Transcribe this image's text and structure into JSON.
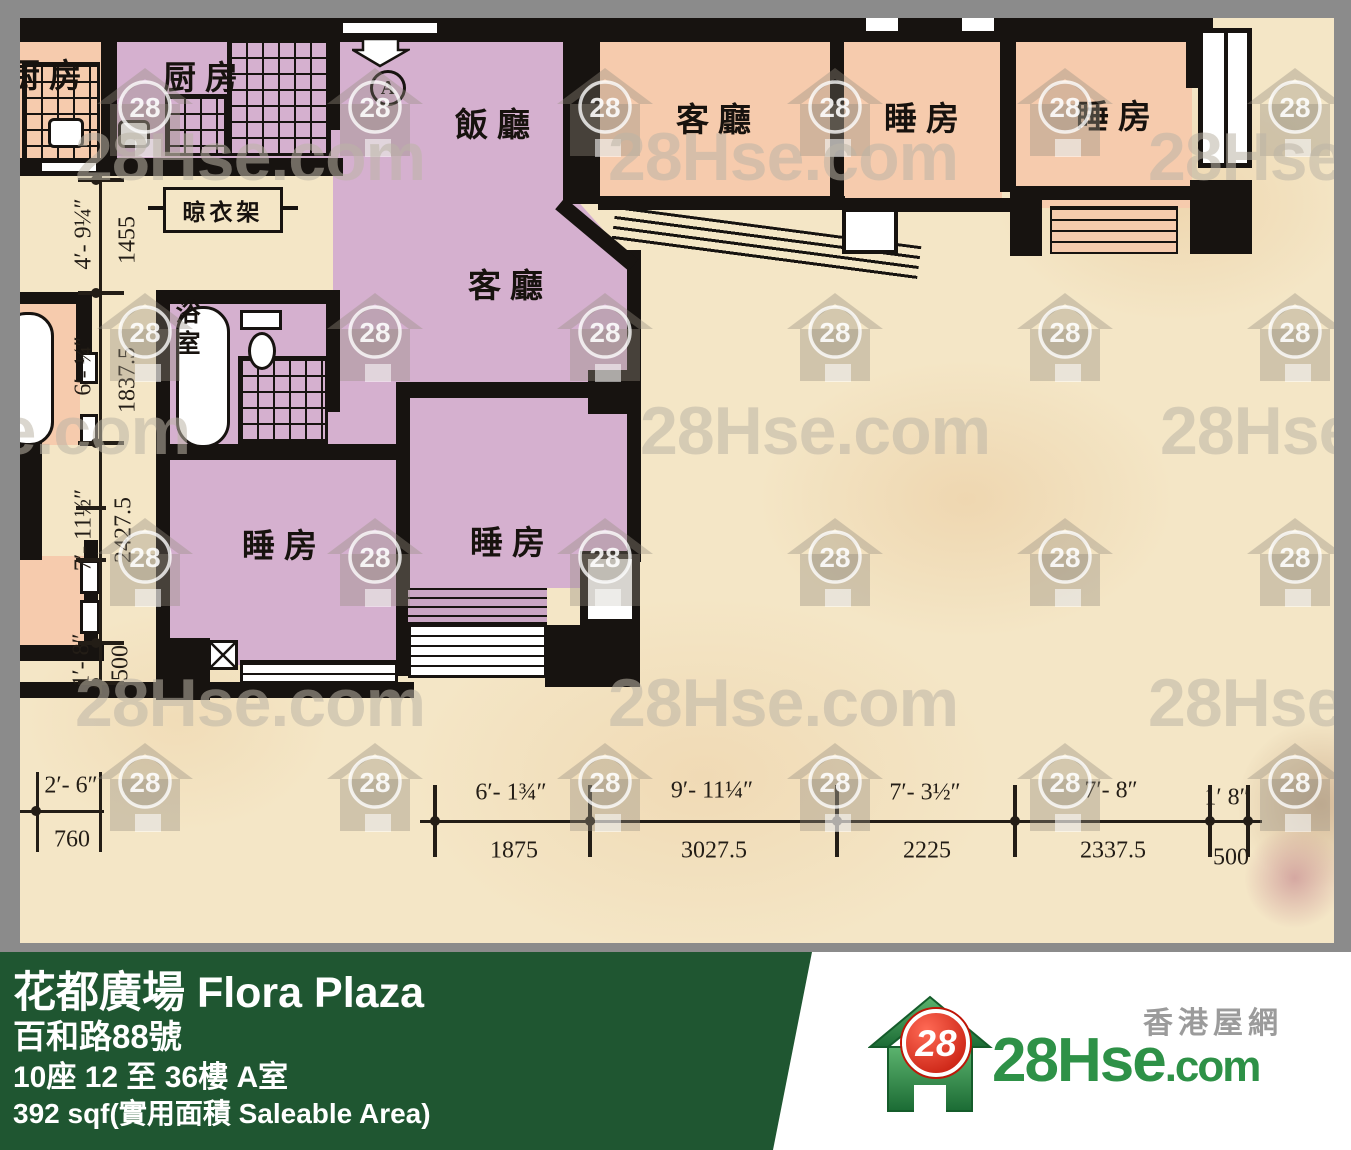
{
  "colors": {
    "wall": "#171310",
    "unit_fill": "#d5b0cf",
    "adjacent_fill": "#f6cbad",
    "paper": "#f4e6c6",
    "frame": "#8b8b8b",
    "banner_bg": "#1f5631",
    "logo_green": "#2e9147",
    "logo_red": "#d6281a",
    "watermark_gray": "#bcb4a6"
  },
  "watermark": {
    "text": "28Hse.com",
    "badge": "28"
  },
  "plan": {
    "labels": {
      "kitchen": "厨房",
      "dining": "飯廳",
      "living": "客廳",
      "bedroom": "睡房",
      "bathroom": "浴室",
      "drying_rack": "晾衣架",
      "entrance_marker": "A"
    },
    "dims": {
      "vertical": [
        {
          "ft": "4′- 9¼″",
          "mm": "1455"
        },
        {
          "ft": "6′- ¼″",
          "mm": "1837.5"
        },
        {
          "ft": "7′- 11½″",
          "mm": "2427.5"
        },
        {
          "ft": "1′- 8″",
          "mm": "500"
        }
      ],
      "horizontal": [
        {
          "ft": "6′- 1¾″",
          "mm": "1875"
        },
        {
          "ft": "9′- 11¼″",
          "mm": "3027.5"
        },
        {
          "ft": "7′- 3½″",
          "mm": "2225"
        },
        {
          "ft": "7′- 8″",
          "mm": "2337.5"
        },
        {
          "ft": "1′ 8″",
          "mm": "500"
        }
      ],
      "left": {
        "ft": "2′- 6″",
        "mm": "760"
      }
    }
  },
  "banner": {
    "title": "花都廣場 Flora Plaza",
    "address": "百和路88號",
    "unit": "10座 12 至 36樓 A室",
    "area": "392 sqf(實用面積 Saleable Area)"
  },
  "logo": {
    "badge": "28",
    "name": "28Hse",
    "suffix": ".com",
    "tagline": "香港屋網"
  }
}
